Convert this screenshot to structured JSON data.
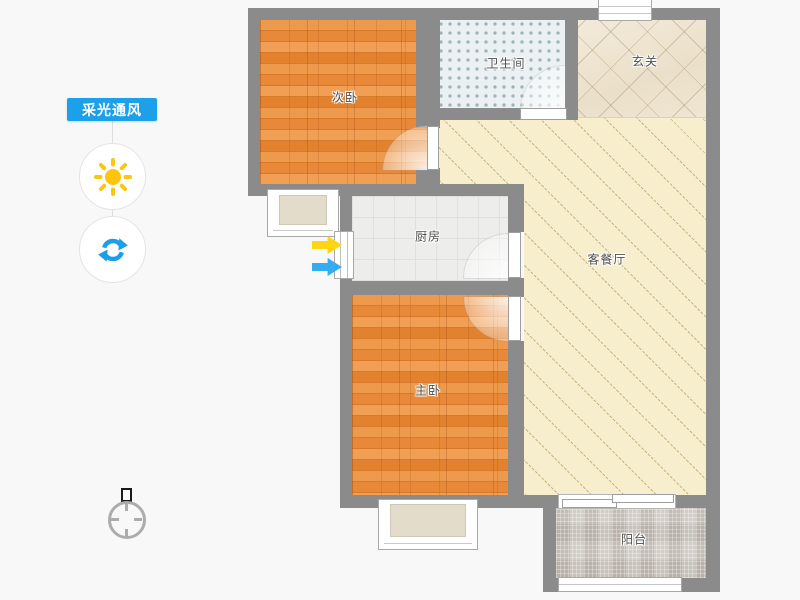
{
  "app": {
    "background": "#F8F8F8"
  },
  "sidebar": {
    "tool_label": "采光通风",
    "tool_label_bg": "#1BA0E9",
    "tool_label_color": "#FFFFFF",
    "buttons": [
      {
        "id": "daylight",
        "icon": "sun-icon",
        "color": "#FFC40E"
      },
      {
        "id": "rotate",
        "icon": "rotate-icon",
        "color": "#1C9FE9"
      }
    ]
  },
  "floorplan": {
    "rooms": [
      {
        "id": "secondary-bedroom",
        "label": "次卧",
        "floor": "wood"
      },
      {
        "id": "bathroom",
        "label": "卫生间",
        "floor": "dotted-tile"
      },
      {
        "id": "entry-hall",
        "label": "玄关",
        "floor": "diagonal-marble"
      },
      {
        "id": "kitchen",
        "label": "厨房",
        "floor": "grid-tile"
      },
      {
        "id": "living-dining",
        "label": "客餐厅",
        "floor": "diagonal-hatch"
      },
      {
        "id": "master-bedroom",
        "label": "主卧",
        "floor": "wood"
      },
      {
        "id": "balcony",
        "label": "阳台",
        "floor": "mosaic-tile"
      }
    ],
    "colors": {
      "wall": "#8B8B8B",
      "wood": "#E78A3E",
      "bathroom": "#EBF1F2",
      "entry_hall": "#EEE5D1",
      "living": "#F7EECD",
      "kitchen": "#EDEEEC",
      "balcony": "#CCC6BF"
    },
    "flow_arrows": [
      {
        "id": "daylight-arrow",
        "direction": "right",
        "color": "#FFD512"
      },
      {
        "id": "wind-arrow",
        "direction": "right",
        "color": "#33ADF1"
      }
    ]
  },
  "compass": {
    "icon": "north-indicator"
  }
}
